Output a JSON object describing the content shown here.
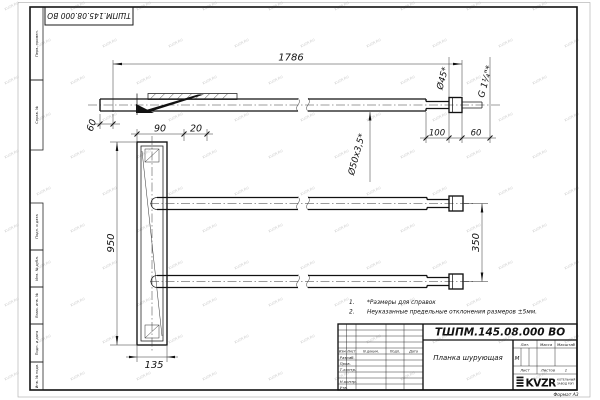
{
  "sheet": {
    "watermark": "KVZR.RU",
    "format_label": "Формат А3",
    "top_stamp_number": "ТШПМ.145.08.000 ВО"
  },
  "side_stamps": {
    "s1": "Перв. примен.",
    "s2": "Справ. №",
    "s3": "Подп. и дата",
    "s4": "Инв. № дубл.",
    "s5": "Взам. инв. №",
    "s6": "Подп. и дата",
    "s7": "Инв. № подл."
  },
  "drawing": {
    "dim_total_length": "1786",
    "dim_overhang": "60",
    "dim_bracket_width": "90",
    "dim_bracket_offset": "20",
    "dim_plank_height": "950",
    "dim_plank_width": "135",
    "dim_pipe_spacing": "350",
    "dim_tip_length": "100",
    "dim_tip_end": "60",
    "label_pipe_spec": "Ø50x3,5*",
    "label_tip_diameter": "Ø45*",
    "label_thread": "G 1¼\"*"
  },
  "notes": {
    "n1_num": "1.",
    "n1_text": "*Размеры для справок",
    "n2_num": "2.",
    "n2_text": "Неуказанные предельные отклонения размеров ±5мм."
  },
  "title_block": {
    "doc_number": "ТШПМ.145.08.000 ВО",
    "part_name": "Планка шурующая",
    "col_izm": "Изм",
    "col_list": "Лист",
    "col_ndoc": "N докум.",
    "col_podp": "Подп.",
    "col_data": "Дата",
    "row_razrab": "Разраб.",
    "row_prov": "Пров.",
    "row_tkontr": "Т.контр.",
    "row_nkontr": "Н.контр.",
    "row_utv": "Утв.",
    "lit_header": "Лит.",
    "massa_header": "Масса",
    "masshtab_header": "Масштаб",
    "lit_value": "М",
    "list_label": "Лист",
    "listov_label": "Листов",
    "listov_value": "1",
    "logo_text": "KVZR",
    "logo_sub1": "КОТЕЛЬНЫЙ",
    "logo_sub2": "ЗАВОД РЭП"
  }
}
